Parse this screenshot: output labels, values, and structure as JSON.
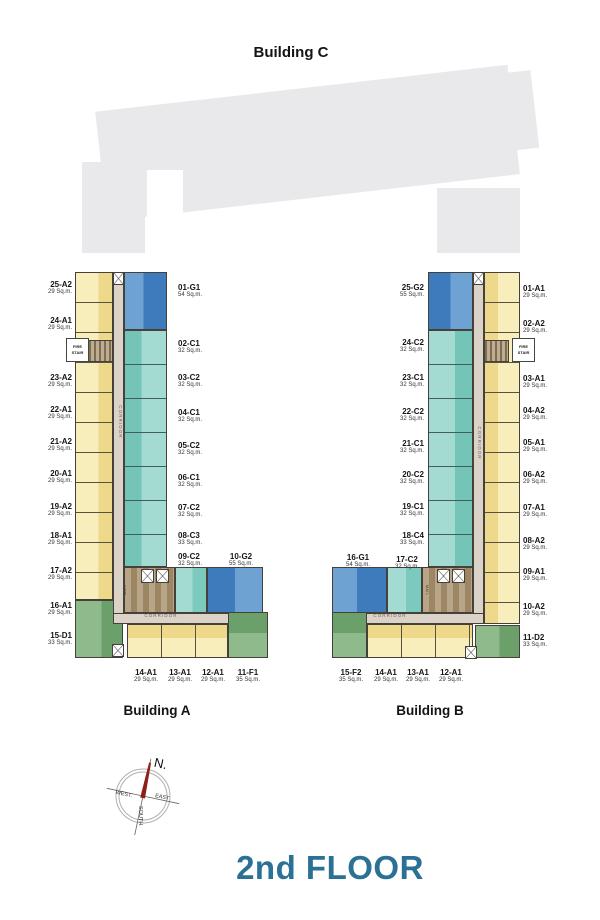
{
  "page": {
    "floor_title": "2nd FLOOR"
  },
  "building_c": {
    "title": "Building C"
  },
  "compass": {
    "north": "N.",
    "west": "WEST.",
    "east": "EAST",
    "south": "SOUTH."
  },
  "building_a": {
    "title": "Building A",
    "corridor_vertical": "CORRIDOR",
    "corridor_horizontal": "CORRIDOR",
    "fire_stair": "FIRE STAIR",
    "mail": "MAIL",
    "left_units": [
      {
        "code": "25-A2",
        "area": "29 Sq.m."
      },
      {
        "code": "24-A1",
        "area": "29 Sq.m."
      },
      {
        "code": "23-A2",
        "area": "29 Sq.m."
      },
      {
        "code": "22-A1",
        "area": "29 Sq.m."
      },
      {
        "code": "21-A2",
        "area": "29 Sq.m."
      },
      {
        "code": "20-A1",
        "area": "29 Sq.m."
      },
      {
        "code": "19-A2",
        "area": "29 Sq.m."
      },
      {
        "code": "18-A1",
        "area": "29 Sq.m."
      },
      {
        "code": "17-A2",
        "area": "29 Sq.m."
      },
      {
        "code": "16-A1",
        "area": "29 Sq.m."
      },
      {
        "code": "15-D1",
        "area": "33 Sq.m."
      }
    ],
    "right_units": [
      {
        "code": "01-G1",
        "area": "54 Sq.m."
      },
      {
        "code": "02-C1",
        "area": "32 Sq.m."
      },
      {
        "code": "03-C2",
        "area": "32 Sq.m."
      },
      {
        "code": "04-C1",
        "area": "32 Sq.m."
      },
      {
        "code": "05-C2",
        "area": "32 Sq.m."
      },
      {
        "code": "06-C1",
        "area": "32 Sq.m."
      },
      {
        "code": "07-C2",
        "area": "32 Sq.m."
      },
      {
        "code": "08-C3",
        "area": "33 Sq.m."
      },
      {
        "code": "09-C2",
        "area": "32 Sq.m."
      }
    ],
    "wing_top_units": [
      {
        "code": "10-G2",
        "area": "55 Sq.m."
      }
    ],
    "bottom_units": [
      {
        "code": "14-A1",
        "area": "29 Sq.m."
      },
      {
        "code": "13-A1",
        "area": "29 Sq.m."
      },
      {
        "code": "12-A1",
        "area": "29 Sq.m."
      },
      {
        "code": "11-F1",
        "area": "35 Sq.m."
      }
    ]
  },
  "building_b": {
    "title": "Building B",
    "corridor_vertical": "CORRIDOR",
    "corridor_horizontal": "CORRIDOR",
    "fire_stair": "FIRE STAIR",
    "mail": "MAIL",
    "left_units": [
      {
        "code": "25-G2",
        "area": "55 Sq.m."
      },
      {
        "code": "24-C2",
        "area": "32 Sq.m."
      },
      {
        "code": "23-C1",
        "area": "32 Sq.m."
      },
      {
        "code": "22-C2",
        "area": "32 Sq.m."
      },
      {
        "code": "21-C1",
        "area": "32 Sq.m."
      },
      {
        "code": "20-C2",
        "area": "32 Sq.m."
      },
      {
        "code": "19-C1",
        "area": "32 Sq.m."
      },
      {
        "code": "18-C4",
        "area": "33 Sq.m."
      }
    ],
    "wing_top_units": [
      {
        "code": "16-G1",
        "area": "54 Sq.m."
      },
      {
        "code": "17-C2",
        "area": "32 Sq.m."
      }
    ],
    "right_units": [
      {
        "code": "01-A1",
        "area": "29 Sq.m."
      },
      {
        "code": "02-A2",
        "area": "29 Sq.m."
      },
      {
        "code": "03-A1",
        "area": "29 Sq.m."
      },
      {
        "code": "04-A2",
        "area": "29 Sq.m."
      },
      {
        "code": "05-A1",
        "area": "29 Sq.m."
      },
      {
        "code": "06-A2",
        "area": "29 Sq.m."
      },
      {
        "code": "07-A1",
        "area": "29 Sq.m."
      },
      {
        "code": "08-A2",
        "area": "29 Sq.m."
      },
      {
        "code": "09-A1",
        "area": "29 Sq.m."
      },
      {
        "code": "10-A2",
        "area": "29 Sq.m."
      },
      {
        "code": "11-D2",
        "area": "33 Sq.m."
      }
    ],
    "bottom_units": [
      {
        "code": "15-F2",
        "area": "35 Sq.m."
      },
      {
        "code": "14-A1",
        "area": "29 Sq.m."
      },
      {
        "code": "13-A1",
        "area": "29 Sq.m."
      },
      {
        "code": "12-A1",
        "area": "29 Sq.m."
      }
    ]
  }
}
